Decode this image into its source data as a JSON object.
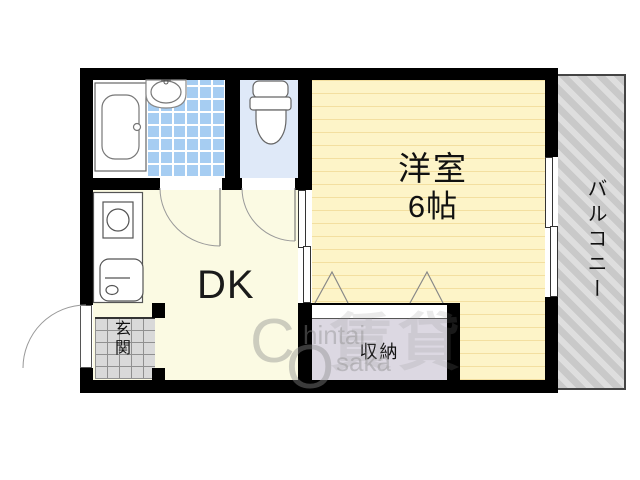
{
  "rooms": {
    "western": {
      "label": "洋室",
      "size": "6帖"
    },
    "dk": {
      "label": "DK"
    },
    "closet": {
      "label": "収納"
    },
    "entrance": {
      "label": "玄関"
    },
    "balcony": {
      "label": "バルコニー"
    }
  },
  "watermark": {
    "big_c": "C",
    "rest1": "hintai",
    "big_o": "O",
    "rest2": "saka",
    "kanji": "賃貸"
  },
  "colors": {
    "wall": "#000000",
    "western_floor": "#fdf4c8",
    "western_floor_line": "#f3dfa0",
    "dk_floor": "#fbfae3",
    "bath_tile": "#a6cdf2",
    "toilet_floor": "#dfe9f8",
    "entrance_tile": "#d9d9d9",
    "closet_fill": "#dcd8e2",
    "balcony_fill": "#c9c9c9"
  }
}
